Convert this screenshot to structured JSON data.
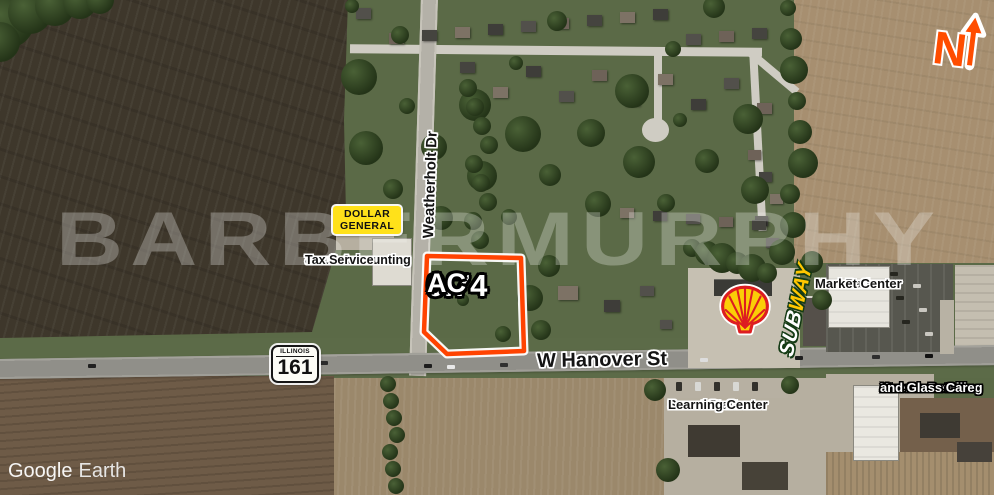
{
  "watermark": "BARBERMURPHY",
  "attribution": {
    "brand": "Google",
    "product": "Earth"
  },
  "north": {
    "label": "N"
  },
  "parcel": {
    "area": "0.74",
    "unit": "AC",
    "outline_color": "#ff4301"
  },
  "roads": {
    "hanover": "W Hanover St",
    "weatherholt": "Weatherholt Dr",
    "shield": {
      "state": "ILLINOIS",
      "number": "161"
    }
  },
  "places": {
    "dollar_general": {
      "line1": "DOLLAR",
      "line2": "GENERAL"
    },
    "traub": {
      "line1": "Traub Accounting",
      "line2": "&",
      "line3": "Tax Service"
    },
    "subway": {
      "part1": "SUB",
      "part2": "WAY"
    },
    "new_baden": {
      "line1": "New Baden",
      "line2": "Market Center"
    },
    "smart_start": {
      "line1": "Smart Start",
      "line2": "Learning Center"
    },
    "xtreme": {
      "line1": "Xtreme Detailing",
      "line2": "and Glass Care"
    }
  },
  "icons": {
    "shell": "shell-pecten-logo",
    "north_arrow": "north-arrow",
    "parcel_outline": "parcel-boundary"
  },
  "colors": {
    "parcel_outline": "#ff4301",
    "dollar_general_yellow": "#ffe11a",
    "subway_yellow": "#ffc600",
    "shell_red": "#dd1d21",
    "shell_yellow": "#fbce07",
    "north_orange": "#ff4d00"
  }
}
